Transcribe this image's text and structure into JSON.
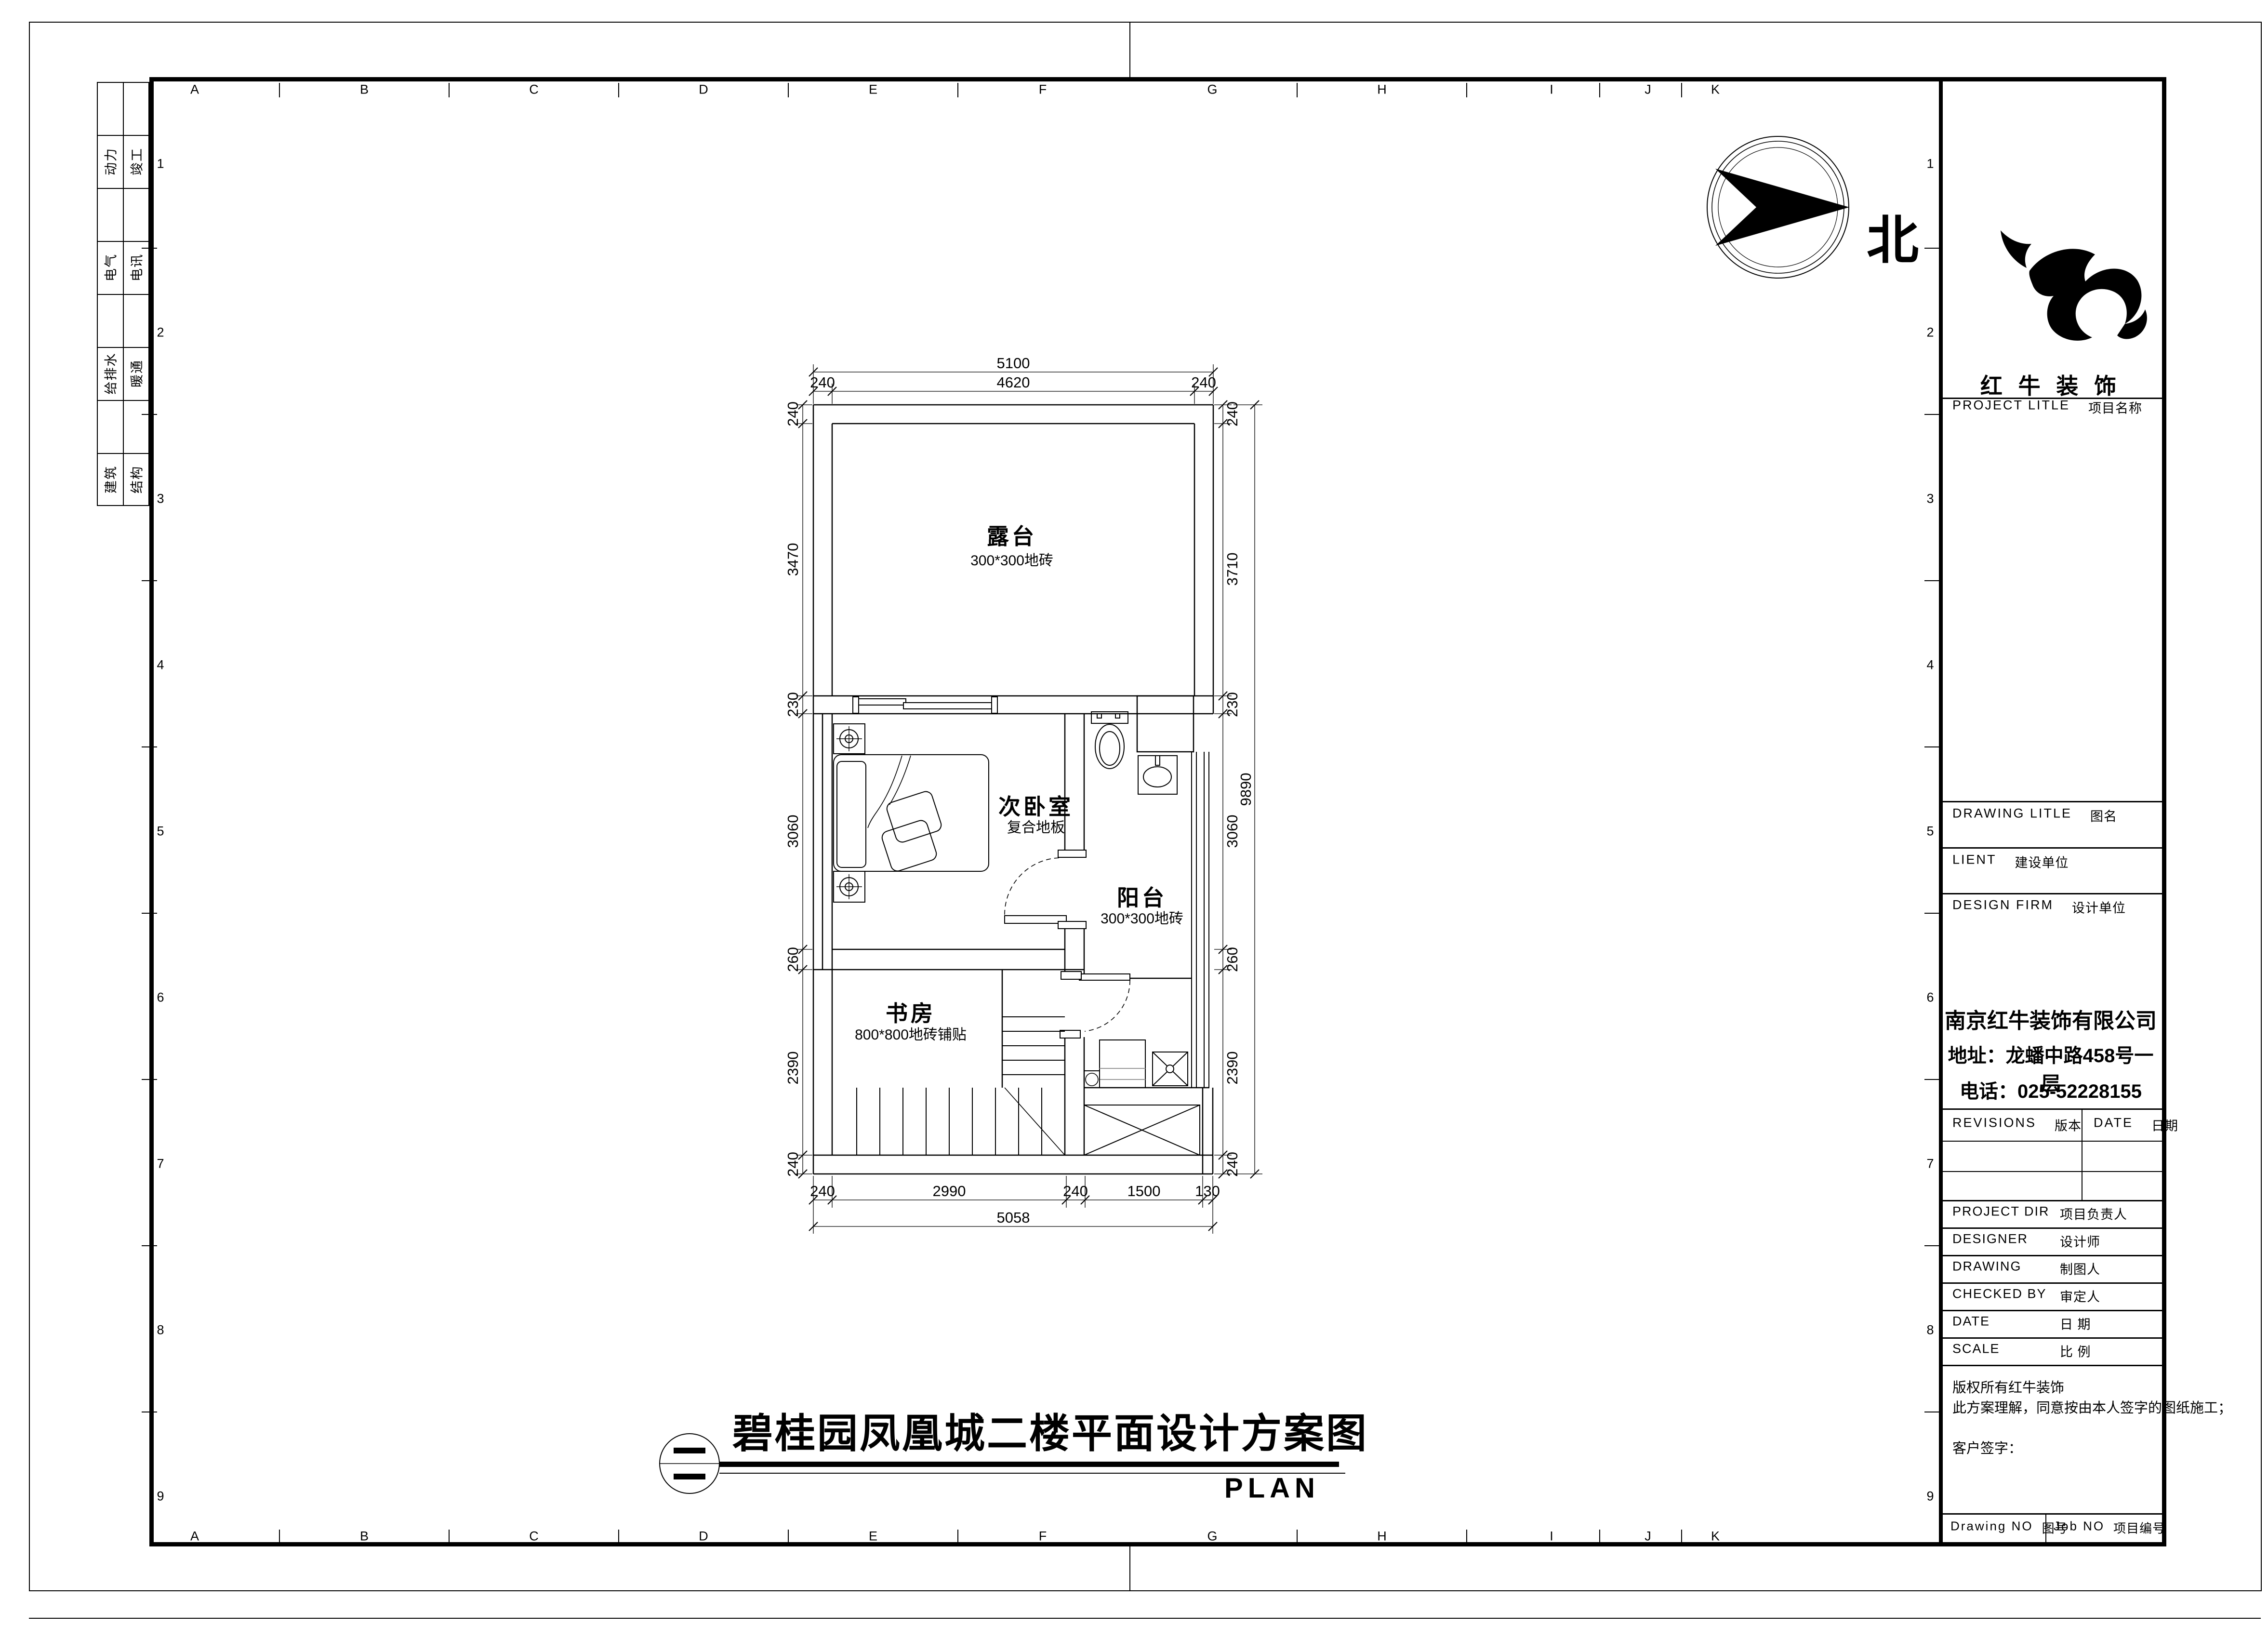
{
  "sheet": {
    "grid_letters": [
      "A",
      "B",
      "C",
      "D",
      "E",
      "F",
      "G",
      "H",
      "I",
      "J",
      "K"
    ],
    "grid_numbers": [
      "1",
      "2",
      "3",
      "4",
      "5",
      "6",
      "7",
      "8",
      "9"
    ],
    "discipline_strip": [
      {
        "col1": "动力",
        "col2": "竣工"
      },
      {
        "col1": "电气",
        "col2": "电讯"
      },
      {
        "col1": "给排水",
        "col2": "暖通"
      },
      {
        "col1": "建筑",
        "col2": "结构"
      }
    ],
    "north_label": "北"
  },
  "plan": {
    "rooms": {
      "terrace": {
        "name": "露台",
        "finish": "300*300地砖"
      },
      "bedroom": {
        "name": "次卧室",
        "finish": "复合地板"
      },
      "balcony": {
        "name": "阳台",
        "finish": "300*300地砖"
      },
      "study": {
        "name": "书房",
        "finish": "800*800地砖铺贴"
      }
    },
    "dims": {
      "top_total": "5100",
      "top": [
        "240",
        "4620",
        "240"
      ],
      "left": [
        "240",
        "3470",
        "230",
        "3060",
        "260",
        "2390",
        "240"
      ],
      "right": [
        "240",
        "3710",
        "230",
        "3060",
        "260",
        "2390",
        "240"
      ],
      "right_total": "9890",
      "bottom": [
        "240",
        "2990",
        "240",
        "1500",
        "130"
      ],
      "bottom_total": "5058"
    }
  },
  "title_block": {
    "logo_text": "红 牛 装 饰",
    "project_title_en": "PROJECT LITLE",
    "project_title_zh": "项目名称",
    "drawing_title_en": "DRAWING LITLE",
    "drawing_title_zh": "图名",
    "client_en": "LIENT",
    "client_zh": "建设单位",
    "design_firm_en": "DESIGN FIRM",
    "design_firm_zh": "设计单位",
    "company_name": "南京红牛装饰有限公司",
    "company_address": "地址：龙蟠中路458号一层",
    "company_phone": "电话：025-52228155",
    "revisions_en": "REVISIONS",
    "revisions_zh": "版本",
    "date_col_en": "DATE",
    "date_col_zh": "日期",
    "project_dir_en": "PROJECT DIR",
    "project_dir_zh": "项目负责人",
    "designer_en": "DESIGNER",
    "designer_zh": "设计师",
    "drawing_en": "DRAWING",
    "drawing_zh": "制图人",
    "checked_en": "CHECKED BY",
    "checked_zh": "审定人",
    "date_en": "DATE",
    "date_zh": "日  期",
    "scale_en": "SCALE",
    "scale_zh": "比  例",
    "copyright1": "版权所有红牛装饰",
    "copyright2": "此方案理解，同意按由本人签字的图纸施工；",
    "sign_label": "客户签字：",
    "drawing_no_en": "Drawing NO",
    "drawing_no_zh": "图号",
    "job_no_en": "Job NO",
    "job_no_zh": "项目编号"
  },
  "footer": {
    "title": "碧桂园凤凰城二楼平面设计方案图",
    "plan_label": "PLAN"
  }
}
